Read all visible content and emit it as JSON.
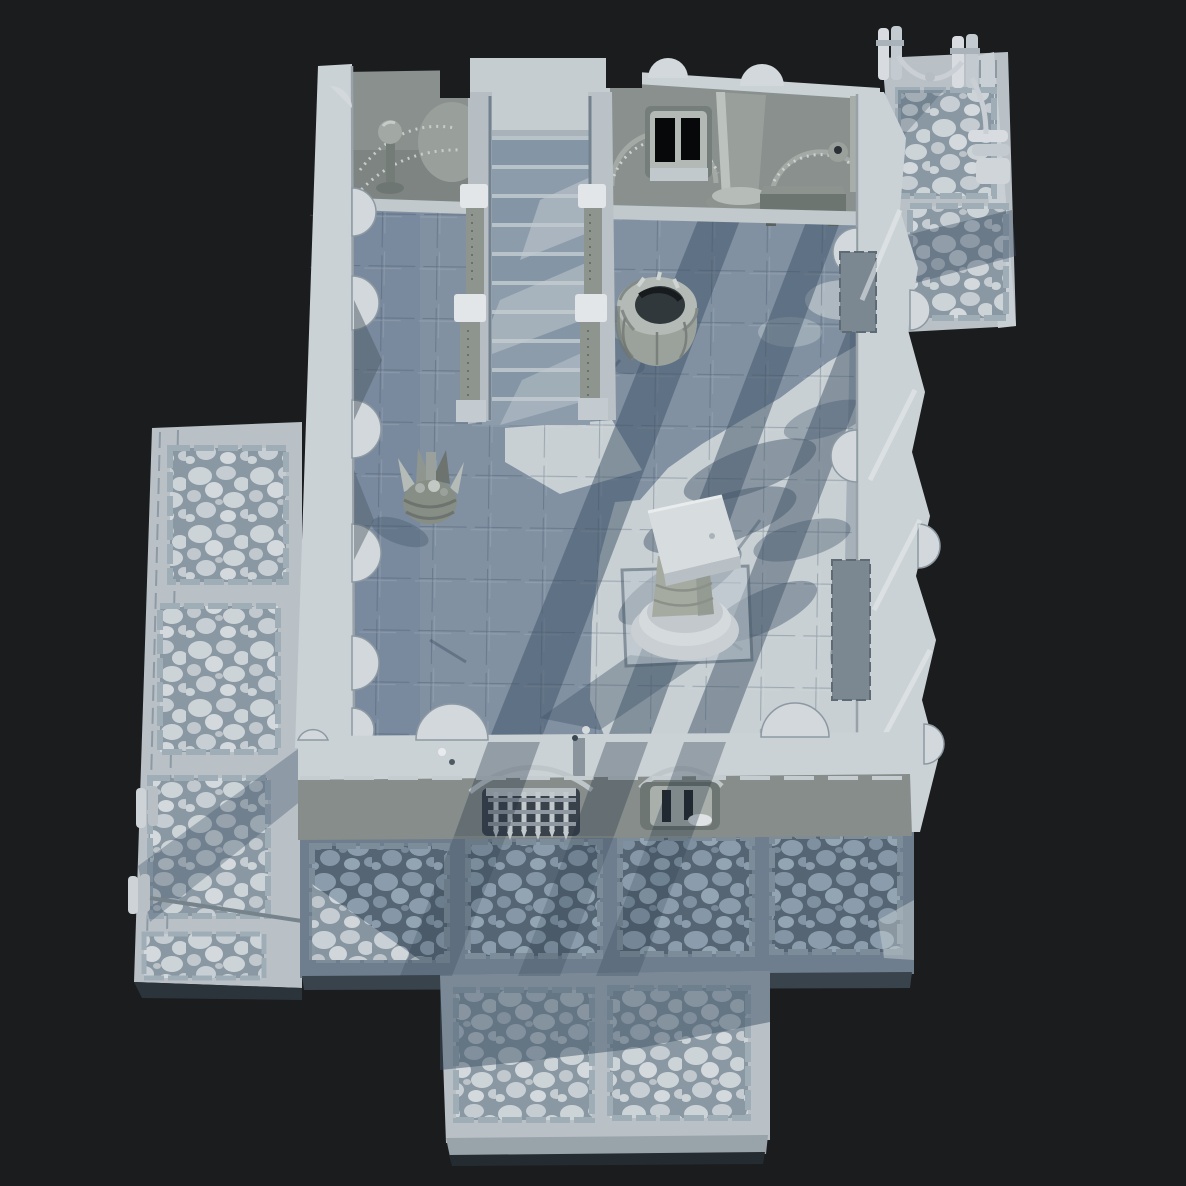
{
  "scene": {
    "kind": "3d-clay-render",
    "description": "Top-down untextured grey render of a modular dungeon room set",
    "colors": {
      "background": "#1b1c1e",
      "wall_top": "#cbd2d6",
      "wall_face": "#89908d",
      "wall_face_dark": "#7d8481",
      "floor_lit": "#c8d0d4",
      "floor_shadow": "#8191a2",
      "cobble_grout_lit": "#8a98a3",
      "cobble_stone_lit": "#cdd4d8",
      "cobble_grout_shade": "#566573",
      "cobble_stone_shade": "#8b9dac",
      "walkway_base": "#b9c1c7",
      "shadow_overlay": "#3e5266",
      "opening_dark": "#060708",
      "prop_stone": "#9ba29d",
      "trim_light": "#dde1e4"
    },
    "objects": [
      {
        "name": "main-hall-room",
        "label": "main hall with stone tile floor"
      },
      {
        "name": "grand-staircase",
        "label": "staircase with railing posts"
      },
      {
        "name": "upper-left-alcove",
        "label": "alcove with torch stand"
      },
      {
        "name": "arched-wall",
        "label": "arched wall with barred window and column"
      },
      {
        "name": "stone-bench",
        "label": "stone bench"
      },
      {
        "name": "stone-well",
        "label": "round stone well"
      },
      {
        "name": "central-pedestal",
        "label": "square-top pedestal on round column"
      },
      {
        "name": "fire-basket",
        "label": "spiked fire basket"
      },
      {
        "name": "portcullis-gate",
        "label": "gate with portcullis grate"
      },
      {
        "name": "south-window",
        "label": "south wall window"
      },
      {
        "name": "left-cobble-walkway",
        "label": "cobblestone walkway (west)"
      },
      {
        "name": "south-cobble-terrace",
        "label": "cobblestone terrace (south)"
      },
      {
        "name": "cobble-pier",
        "label": "cobblestone pier extension"
      },
      {
        "name": "rope-post-platform",
        "label": "platform with rope fence posts"
      },
      {
        "name": "right-wall-columns",
        "label": "east wall with half-columns"
      }
    ]
  }
}
